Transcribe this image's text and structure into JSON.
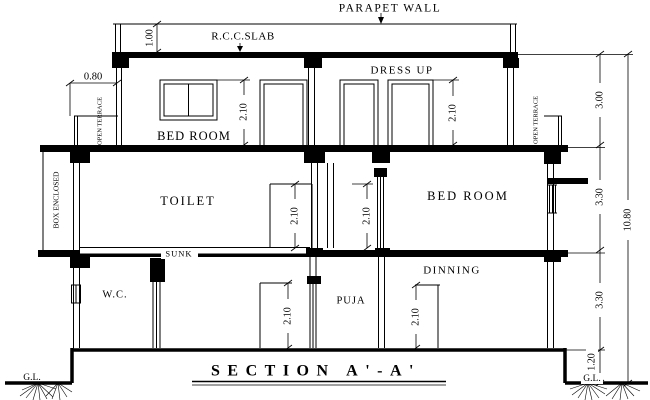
{
  "drawing": {
    "title": "SECTION A'-A'",
    "annotations": {
      "parapet_wall": "PARAPET WALL",
      "rcc_slab": "R.C.C.SLAB",
      "sunk": "SUNK",
      "gl_left": "G.L.",
      "gl_right": "G.L."
    },
    "rooms": {
      "top_floor": {
        "bed_room": "BED ROOM",
        "dress_up": "DRESS UP"
      },
      "first_floor": {
        "toilet": "TOILET",
        "bed_room": "BED ROOM"
      },
      "ground_floor": {
        "wc": "W.C.",
        "puja": "PUJA",
        "dinning": "DINNING"
      }
    },
    "side_labels": {
      "open_terrace_left": "OPEN TERRACE",
      "open_terrace_right": "OPEN TERRACE",
      "box_enclosed": "BOX ENCLOSED"
    },
    "dimensions": {
      "parapet": "1.00",
      "terrace": "0.80",
      "top_bed_door": "2.10",
      "dress_up_door": "2.10",
      "toilet_door": "2.10",
      "first_bed_door": "2.10",
      "wc_door": "2.10",
      "dinning_door": "2.10",
      "top_floor_height": "3.00",
      "first_floor_height": "3.30",
      "ground_floor_height": "3.30",
      "plinth_height": "1.20",
      "total_height": "10.80"
    },
    "colors": {
      "line": "#000000",
      "background": "#ffffff"
    }
  }
}
